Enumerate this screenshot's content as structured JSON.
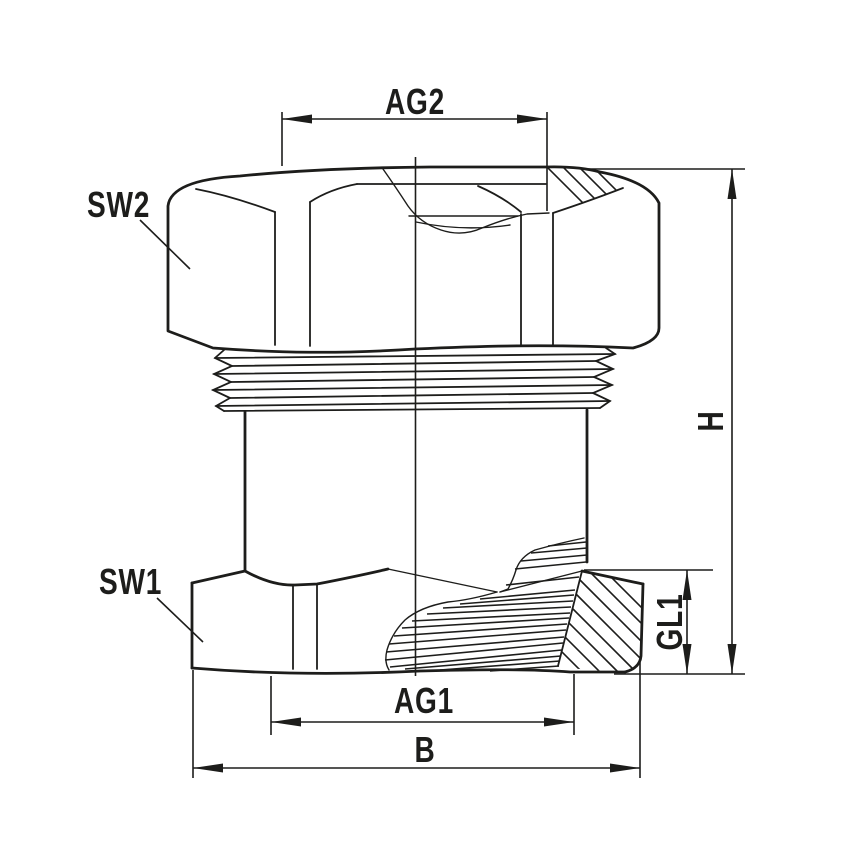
{
  "drawing": {
    "description": "technical drawing of cable gland fitting",
    "colors": {
      "line": "#1d1d1b",
      "background": "#ffffff"
    },
    "labels": {
      "sw2": "SW2",
      "sw1": "SW1",
      "ag2": "AG2",
      "ag1": "AG1",
      "b": "B",
      "h": "H",
      "gl1": "GL1"
    }
  }
}
